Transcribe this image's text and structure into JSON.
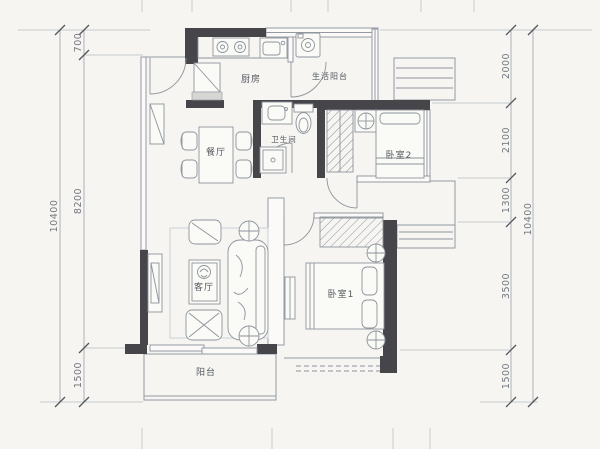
{
  "rooms": {
    "kitchen": "厨房",
    "living_balcony": "生活阳台",
    "dining": "餐厅",
    "bathroom": "卫生间",
    "bedroom2": "卧室2",
    "living_room": "客厅",
    "bedroom1": "卧室1",
    "balcony": "阳台"
  },
  "dims": {
    "left": [
      "700",
      "8200",
      "1500"
    ],
    "left_total": "10400",
    "right": [
      "2000",
      "2100",
      "1300",
      "3500",
      "1500"
    ],
    "right_total": "10400"
  },
  "colors": {
    "wall": "#45454a",
    "thin_line": "#949aa2",
    "paper": "#f6f5f2",
    "dim_text": "#72777d",
    "room_text": "#53575c"
  }
}
